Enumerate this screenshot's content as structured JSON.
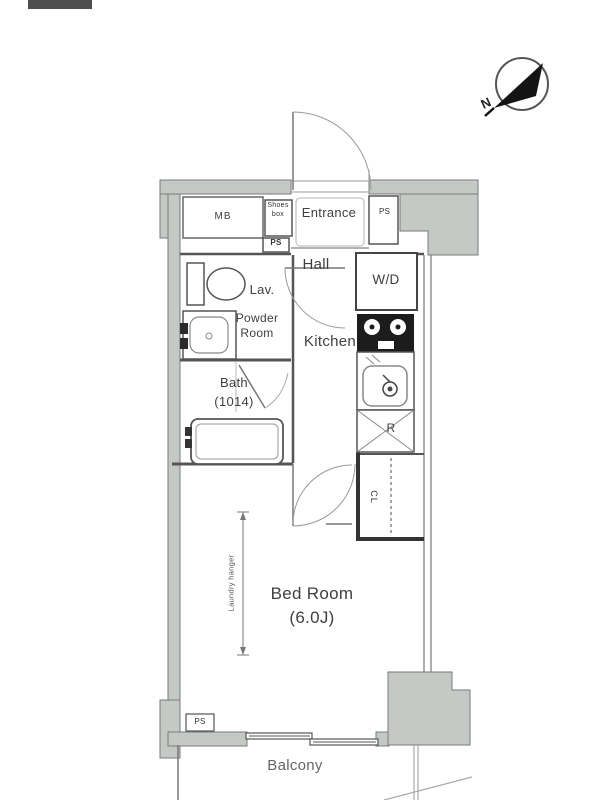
{
  "plan": {
    "type": "apartment floor plan",
    "compass": {
      "north_label": "N"
    },
    "rooms": {
      "entrance": "Entrance",
      "hall": "Hall",
      "lav": "Lav.",
      "powder_room_line1": "Powder",
      "powder_room_line2": "Room",
      "bath_line1": "Bath",
      "bath_line2": "(1014)",
      "kitchen": "Kitchen",
      "bedroom_line1": "Bed Room",
      "bedroom_line2": "(6.0J)",
      "balcony": "Balcony"
    },
    "fixtures": {
      "meter_box": "MB",
      "shoes_box_line1": "Shoes",
      "shoes_box_line2": "box",
      "washer_dryer": "W/D",
      "refrigerator": "R",
      "closet": "CL",
      "laundry_hanger": "Laundry hanger",
      "pipe_space_entrance": "PS",
      "pipe_space_shaft": "PS",
      "pipe_space_bedroom": "PS"
    },
    "colors": {
      "wall_fill": "#c5c9c5",
      "wall_edge": "#7a7a7a",
      "interior_wall": "#555555",
      "ink": "#3f3f3f",
      "fixture_line": "#8a8a8a",
      "needle": "#141414"
    }
  }
}
